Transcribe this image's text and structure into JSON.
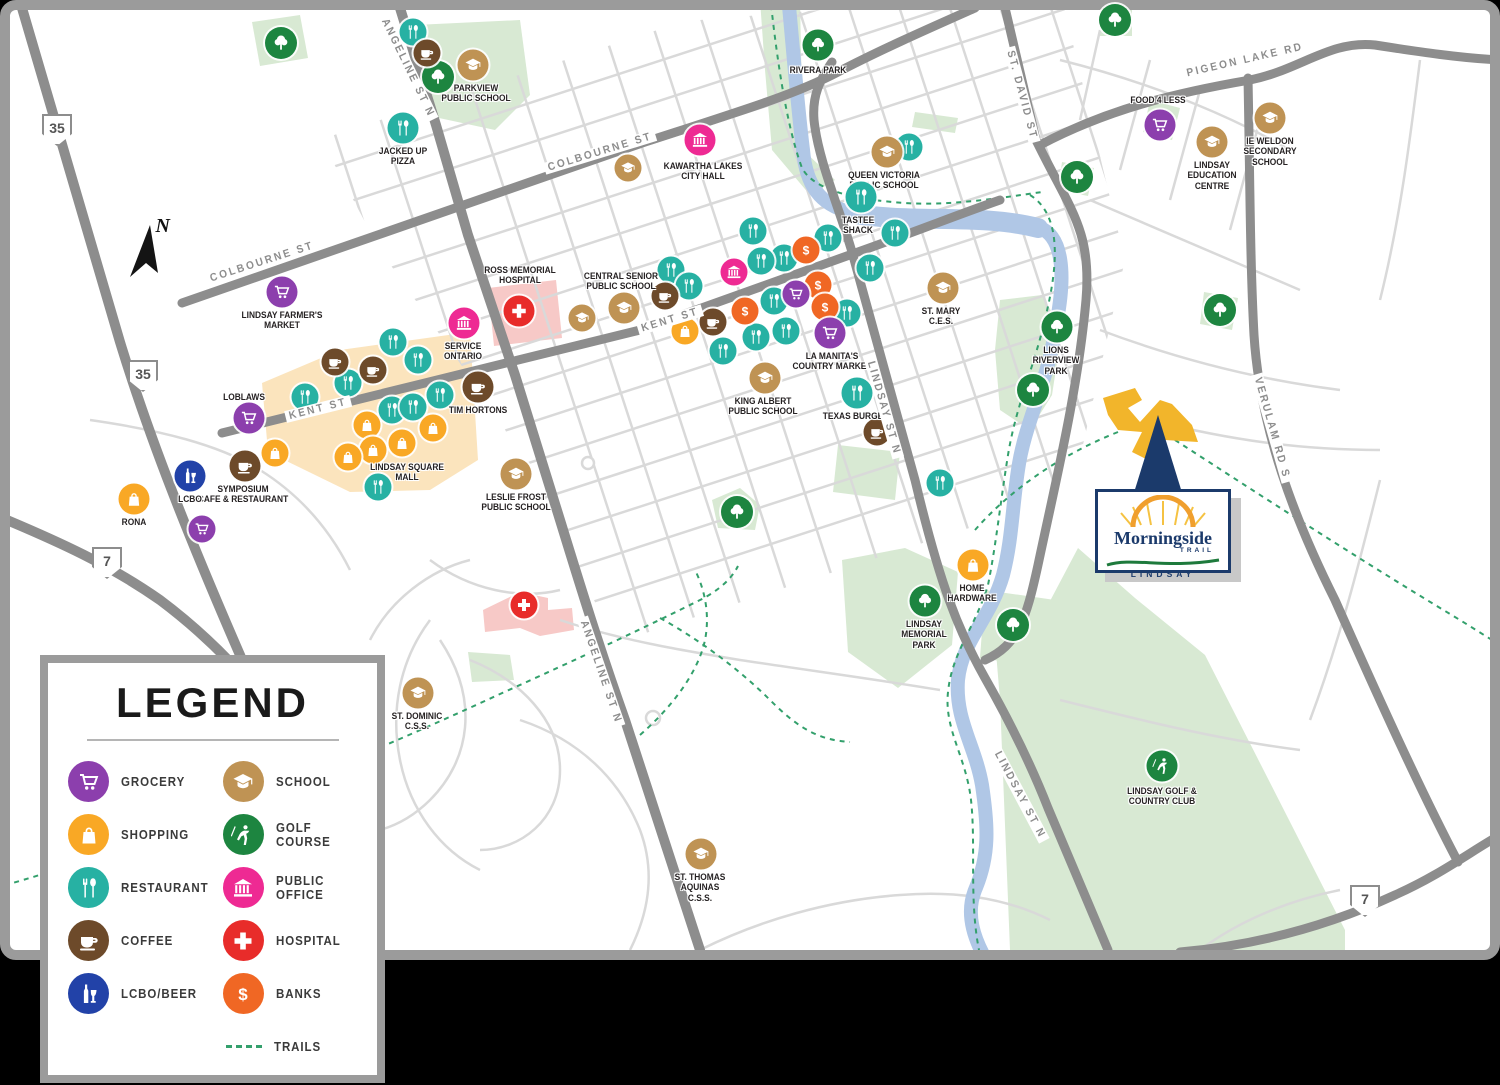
{
  "map": {
    "title": "Morningside Trail Lindsay amenities map",
    "compass_label": "N",
    "colors": {
      "grocery": "#8c3fad",
      "shopping": "#f9a825",
      "restaurant": "#27b1a3",
      "coffee": "#6d4a2a",
      "lcbo": "#2242a8",
      "school": "#bf9354",
      "golf": "#1d8540",
      "public_office": "#ee2a93",
      "hospital": "#e82c2a",
      "bank": "#f06724",
      "tree": "#1d8540",
      "road_major": "#8d8d8d",
      "road_minor": "#d9d9d9",
      "water": "#b0c7e6",
      "park": "#d8e9d3",
      "mall": "#fbe4bd",
      "hospital_area": "#f7c9c7",
      "trail": "#33a06c",
      "navy": "#1b3a6b",
      "sun": "#f09f2e",
      "swoosh": "#1e7a3c"
    },
    "highway_shields": [
      {
        "number": "35",
        "x": 57,
        "y": 130
      },
      {
        "number": "35",
        "x": 143,
        "y": 376
      },
      {
        "number": "7",
        "x": 107,
        "y": 563
      },
      {
        "number": "7",
        "x": 1365,
        "y": 901
      }
    ],
    "road_labels": [
      {
        "text": "COLBOURNE ST",
        "x": 262,
        "y": 262,
        "rotate": -18
      },
      {
        "text": "COLBOURNE ST",
        "x": 600,
        "y": 152,
        "rotate": -17
      },
      {
        "text": "KENT ST",
        "x": 318,
        "y": 409,
        "rotate": -14
      },
      {
        "text": "KENT ST",
        "x": 670,
        "y": 320,
        "rotate": -17
      },
      {
        "text": "ANGELINE ST N",
        "x": 408,
        "y": 68,
        "rotate": 64
      },
      {
        "text": "ANGELINE ST N",
        "x": 601,
        "y": 672,
        "rotate": 71
      },
      {
        "text": "LINDSAY ST N",
        "x": 884,
        "y": 408,
        "rotate": 74
      },
      {
        "text": "LINDSAY ST N",
        "x": 1020,
        "y": 795,
        "rotate": 62
      },
      {
        "text": "ST. DAVID ST",
        "x": 1022,
        "y": 95,
        "rotate": 75
      },
      {
        "text": "PIGEON LAKE RD",
        "x": 1245,
        "y": 60,
        "rotate": -13
      },
      {
        "text": "VERULAM RD S",
        "x": 1272,
        "y": 428,
        "rotate": 74
      }
    ],
    "pois": [
      {
        "name": "Parkview Public School",
        "type": "school",
        "x": 473,
        "y": 65,
        "lx": 476,
        "ly": 84,
        "label": "PARKVIEW\nPUBLIC SCHOOL"
      },
      {
        "name": "Jacked Up Pizza",
        "type": "restaurant",
        "x": 403,
        "y": 128,
        "lx": 403,
        "ly": 147,
        "label": "JACKED UP\nPIZZA"
      },
      {
        "name": "Lindsay Farmer's Market",
        "type": "grocery",
        "x": 282,
        "y": 292,
        "lx": 282,
        "ly": 311,
        "label": "LINDSAY FARMER'S\nMARKET"
      },
      {
        "name": "Kawartha Lakes City Hall",
        "type": "public_office",
        "x": 700,
        "y": 140,
        "lx": 703,
        "ly": 162,
        "label": "KAWARTHA LAKES\nCITY HALL"
      },
      {
        "name": "Rivera Park",
        "type": "tree",
        "x": 818,
        "y": 45,
        "lx": 818,
        "ly": 66,
        "label": "RIVERA PARK"
      },
      {
        "name": "Queen Victoria Public School",
        "type": "school",
        "x": 887,
        "y": 152,
        "lx": 884,
        "ly": 171,
        "label": "QUEEN VICTORIA\nPUBLIC SCHOOL"
      },
      {
        "name": "Tastee Shack",
        "type": "restaurant",
        "x": 861,
        "y": 197,
        "lx": 858,
        "ly": 216,
        "label": "TASTEE\nSHACK"
      },
      {
        "name": "Food 4 Less",
        "type": "grocery",
        "x": 1160,
        "y": 125,
        "lx": 1158,
        "ly": 96,
        "label": "FOOD 4 LESS"
      },
      {
        "name": "Lindsay Education Centre",
        "type": "school",
        "x": 1212,
        "y": 142,
        "lx": 1212,
        "ly": 161,
        "label": "LINDSAY\nEDUCATION\nCENTRE"
      },
      {
        "name": "IE Weldon Secondary School",
        "type": "school",
        "x": 1270,
        "y": 118,
        "lx": 1270,
        "ly": 137,
        "label": "IE WELDON\nSECONDARY\nSCHOOL"
      },
      {
        "name": "Ross Memorial Hospital",
        "type": "hospital",
        "x": 519,
        "y": 311,
        "lx": 520,
        "ly": 266,
        "label": "ROSS MEMORIAL\nHOSPITAL"
      },
      {
        "name": "Central Senior Public School",
        "type": "school",
        "x": 624,
        "y": 308,
        "lx": 621,
        "ly": 272,
        "label": "CENTRAL SENIOR\nPUBLIC SCHOOL"
      },
      {
        "name": "Service Ontario",
        "type": "public_office",
        "x": 464,
        "y": 323,
        "lx": 463,
        "ly": 342,
        "label": "SERVICE\nONTARIO"
      },
      {
        "name": "Loblaws",
        "type": "grocery",
        "x": 249,
        "y": 418,
        "lx": 244,
        "ly": 393,
        "label": "LOBLAWS"
      },
      {
        "name": "Tim Hortons",
        "type": "coffee",
        "x": 478,
        "y": 387,
        "lx": 478,
        "ly": 406,
        "label": "TIM HORTONS"
      },
      {
        "name": "Symposium Cafe & Restaurant",
        "type": "coffee",
        "x": 245,
        "y": 466,
        "lx": 243,
        "ly": 485,
        "label": "SYMPOSIUM\nCAFE & RESTAURANT"
      },
      {
        "name": "LCBO",
        "type": "lcbo",
        "x": 190,
        "y": 476,
        "lx": 190,
        "ly": 495,
        "label": "LCBO"
      },
      {
        "name": "Rona",
        "type": "shopping",
        "x": 134,
        "y": 499,
        "lx": 134,
        "ly": 518,
        "label": "RONA"
      },
      {
        "name": "Leslie Frost Public School",
        "type": "school",
        "x": 516,
        "y": 474,
        "lx": 516,
        "ly": 493,
        "label": "LESLIE FROST\nPUBLIC SCHOOL"
      },
      {
        "name": "King Albert Public School",
        "type": "school",
        "x": 765,
        "y": 378,
        "lx": 763,
        "ly": 397,
        "label": "KING ALBERT\nPUBLIC SCHOOL"
      },
      {
        "name": "La Manita's Country Market",
        "type": "grocery",
        "x": 830,
        "y": 333,
        "lx": 832,
        "ly": 352,
        "label": "LA MANITA'S\nCOUNTRY MARKET"
      },
      {
        "name": "Texas Burger",
        "type": "restaurant",
        "x": 857,
        "y": 393,
        "lx": 856,
        "ly": 412,
        "label": "TEXAS BURGER"
      },
      {
        "name": "St. Mary C.E.S.",
        "type": "school",
        "x": 943,
        "y": 288,
        "lx": 941,
        "ly": 307,
        "label": "ST. MARY\nC.E.S."
      },
      {
        "name": "Lions Riverview Park",
        "type": "tree",
        "x": 1057,
        "y": 327,
        "lx": 1056,
        "ly": 346,
        "label": "LIONS\nRIVERVIEW\nPARK"
      },
      {
        "name": "Home Hardware",
        "type": "shopping",
        "x": 973,
        "y": 565,
        "lx": 972,
        "ly": 584,
        "label": "HOME\nHARDWARE"
      },
      {
        "name": "Lindsay Memorial Park",
        "type": "tree",
        "x": 925,
        "y": 601,
        "lx": 924,
        "ly": 620,
        "label": "LINDSAY\nMEMORIAL\nPARK"
      },
      {
        "name": "St. Dominic C.S.S.",
        "type": "school",
        "x": 418,
        "y": 693,
        "lx": 417,
        "ly": 712,
        "label": "ST. DOMINIC\nC.S.S."
      },
      {
        "name": "St. Thomas Aquinas C.S.S.",
        "type": "school",
        "x": 701,
        "y": 854,
        "lx": 700,
        "ly": 873,
        "label": "ST. THOMAS\nAQUINAS\nC.S.S."
      },
      {
        "name": "Lindsay Golf & Country Club",
        "type": "golf",
        "x": 1162,
        "y": 766,
        "lx": 1162,
        "ly": 787,
        "label": "LINDSAY GOLF &\nCOUNTRY CLUB"
      }
    ],
    "area_labels": [
      {
        "text": "LINDSAY SQUARE\nMALL",
        "x": 407,
        "y": 463
      }
    ],
    "unlabeled_markers": [
      {
        "type": "tree",
        "x": 281,
        "y": 43
      },
      {
        "type": "tree",
        "x": 438,
        "y": 77
      },
      {
        "type": "tree",
        "x": 1115,
        "y": 20
      },
      {
        "type": "tree",
        "x": 1077,
        "y": 177
      },
      {
        "type": "tree",
        "x": 1033,
        "y": 390
      },
      {
        "type": "tree",
        "x": 1220,
        "y": 310
      },
      {
        "type": "tree",
        "x": 737,
        "y": 512
      },
      {
        "type": "tree",
        "x": 1013,
        "y": 625
      },
      {
        "type": "restaurant",
        "x": 413,
        "y": 32
      },
      {
        "type": "coffee",
        "x": 427,
        "y": 53
      },
      {
        "type": "restaurant",
        "x": 909,
        "y": 147
      },
      {
        "type": "restaurant",
        "x": 753,
        "y": 231
      },
      {
        "type": "restaurant",
        "x": 828,
        "y": 238
      },
      {
        "type": "restaurant",
        "x": 784,
        "y": 258
      },
      {
        "type": "restaurant",
        "x": 761,
        "y": 261
      },
      {
        "type": "restaurant",
        "x": 870,
        "y": 268
      },
      {
        "type": "restaurant",
        "x": 895,
        "y": 233
      },
      {
        "type": "restaurant",
        "x": 671,
        "y": 270
      },
      {
        "type": "restaurant",
        "x": 689,
        "y": 286
      },
      {
        "type": "restaurant",
        "x": 774,
        "y": 301
      },
      {
        "type": "restaurant",
        "x": 847,
        "y": 313
      },
      {
        "type": "restaurant",
        "x": 756,
        "y": 337
      },
      {
        "type": "restaurant",
        "x": 786,
        "y": 331
      },
      {
        "type": "restaurant",
        "x": 723,
        "y": 351
      },
      {
        "type": "bank",
        "x": 806,
        "y": 250
      },
      {
        "type": "bank",
        "x": 818,
        "y": 285
      },
      {
        "type": "bank",
        "x": 825,
        "y": 307
      },
      {
        "type": "bank",
        "x": 745,
        "y": 311
      },
      {
        "type": "grocery",
        "x": 796,
        "y": 294
      },
      {
        "type": "public_office",
        "x": 734,
        "y": 272
      },
      {
        "type": "coffee",
        "x": 665,
        "y": 296
      },
      {
        "type": "coffee",
        "x": 713,
        "y": 322
      },
      {
        "type": "shopping",
        "x": 685,
        "y": 331
      },
      {
        "type": "school",
        "x": 628,
        "y": 168
      },
      {
        "type": "school",
        "x": 582,
        "y": 318
      },
      {
        "type": "shopping",
        "x": 367,
        "y": 425
      },
      {
        "type": "shopping",
        "x": 402,
        "y": 443
      },
      {
        "type": "shopping",
        "x": 433,
        "y": 428
      },
      {
        "type": "shopping",
        "x": 373,
        "y": 450
      },
      {
        "type": "shopping",
        "x": 348,
        "y": 457
      },
      {
        "type": "shopping",
        "x": 275,
        "y": 453
      },
      {
        "type": "restaurant",
        "x": 393,
        "y": 342
      },
      {
        "type": "restaurant",
        "x": 418,
        "y": 360
      },
      {
        "type": "restaurant",
        "x": 348,
        "y": 383
      },
      {
        "type": "restaurant",
        "x": 305,
        "y": 397
      },
      {
        "type": "restaurant",
        "x": 392,
        "y": 410
      },
      {
        "type": "restaurant",
        "x": 413,
        "y": 407
      },
      {
        "type": "restaurant",
        "x": 440,
        "y": 395
      },
      {
        "type": "restaurant",
        "x": 378,
        "y": 487
      },
      {
        "type": "coffee",
        "x": 335,
        "y": 362
      },
      {
        "type": "coffee",
        "x": 373,
        "y": 370
      },
      {
        "type": "coffee",
        "x": 877,
        "y": 432
      },
      {
        "type": "restaurant",
        "x": 940,
        "y": 483
      },
      {
        "type": "grocery",
        "x": 202,
        "y": 529
      },
      {
        "type": "hospital",
        "x": 524,
        "y": 605
      }
    ],
    "logo": {
      "title": "Morningside",
      "subtitle": "TRAIL",
      "city": "LINDSAY"
    }
  },
  "legend": {
    "title": "LEGEND",
    "items": [
      {
        "label": "GROCERY",
        "type": "grocery",
        "color": "#8c3fad",
        "icon": "grocery-icon"
      },
      {
        "label": "SHOPPING",
        "type": "shopping",
        "color": "#f9a825",
        "icon": "shopping-icon"
      },
      {
        "label": "RESTAURANT",
        "type": "restaurant",
        "color": "#27b1a3",
        "icon": "restaurant-icon"
      },
      {
        "label": "COFFEE",
        "type": "coffee",
        "color": "#6d4a2a",
        "icon": "coffee-icon"
      },
      {
        "label": "LCBO/BEER",
        "type": "lcbo",
        "color": "#2242a8",
        "icon": "lcbo-icon"
      },
      {
        "label": "SCHOOL",
        "type": "school",
        "color": "#bf9354",
        "icon": "school-icon"
      },
      {
        "label": "GOLF COURSE",
        "type": "golf",
        "color": "#1d8540",
        "icon": "golf-icon"
      },
      {
        "label": "PUBLIC OFFICE",
        "type": "public_office",
        "color": "#ee2a93",
        "icon": "public-office-icon"
      },
      {
        "label": "HOSPITAL",
        "type": "hospital",
        "color": "#e82c2a",
        "icon": "hospital-icon"
      },
      {
        "label": "BANKS",
        "type": "bank",
        "color": "#f06724",
        "icon": "bank-icon"
      }
    ],
    "trails": {
      "label": "TRAILS",
      "color": "#33a06c",
      "icon": "trail-dash-icon"
    }
  }
}
